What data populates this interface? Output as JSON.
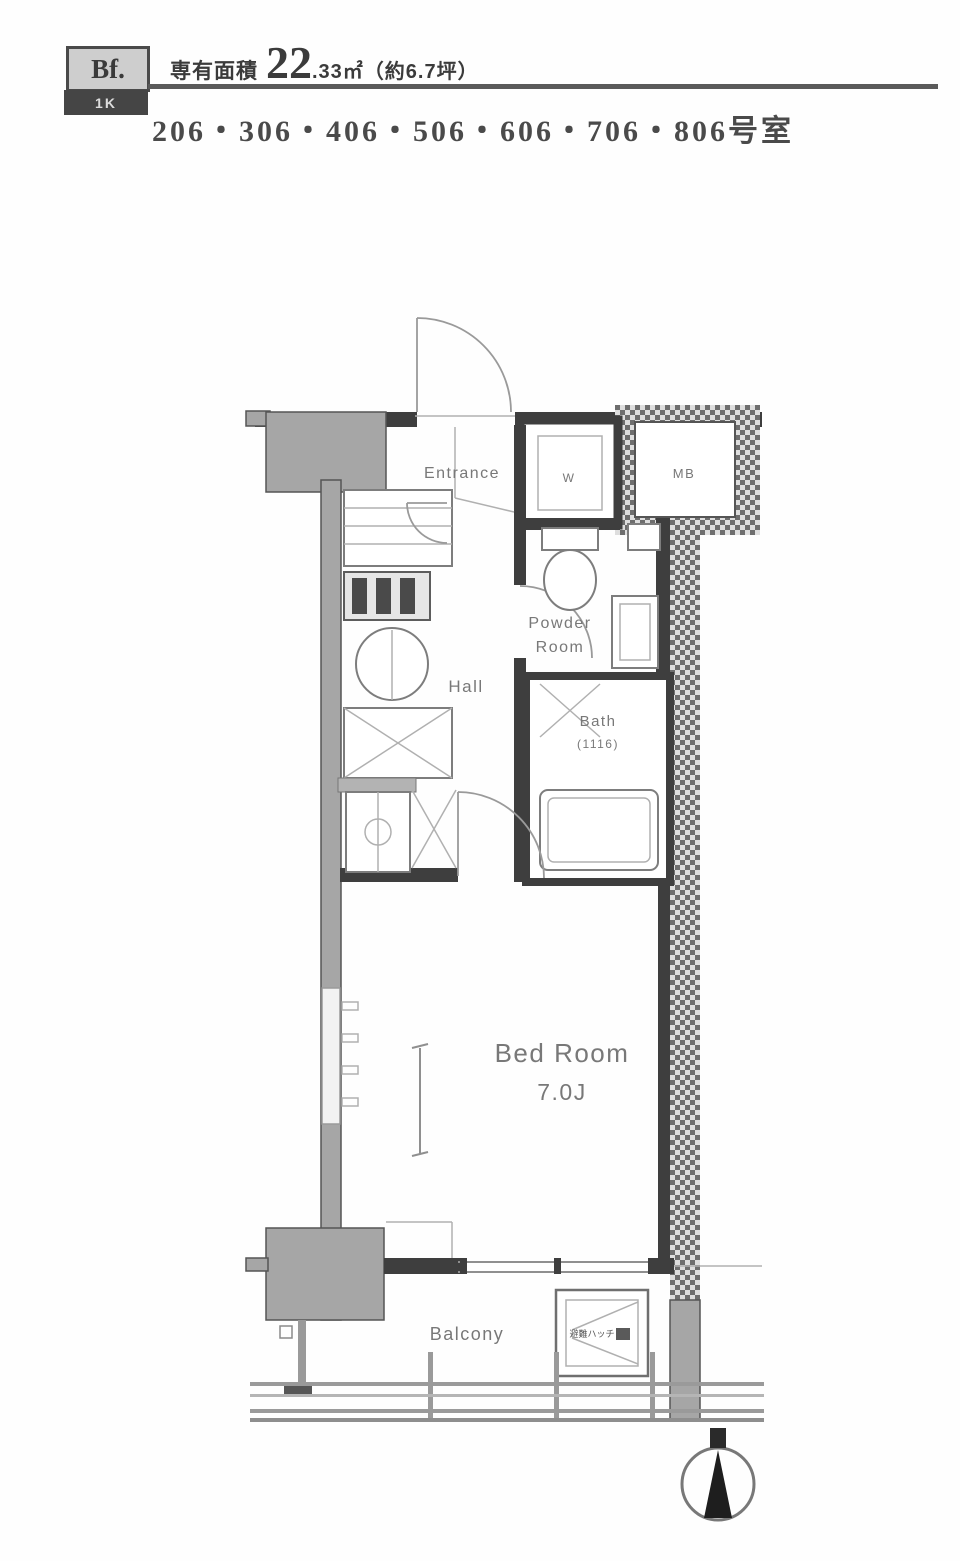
{
  "header": {
    "type_label": "Bf.",
    "unit_type": "1K",
    "area_label": "専有面積",
    "area_value": "22",
    "area_detail": ".33㎡（約6.7坪）",
    "room_numbers": "206・306・406・506・606・706・806号室"
  },
  "plan": {
    "labels": {
      "entrance": "Entrance",
      "hall": "Hall",
      "washer": "W",
      "meter_box": "MB",
      "powder_room_line1": "Powder",
      "powder_room_line2": "Room",
      "bath": "Bath",
      "bath_size": "(1116)",
      "bedroom_line1": "Bed Room",
      "bedroom_line2": "7.0J",
      "balcony": "Balcony",
      "evac_hatch": "避難ハッチ"
    },
    "colors": {
      "wall_dark": "#3e3e3e",
      "wall_gray": "#a6a6a6",
      "fixture_line": "#7d7d7d",
      "label_gray": "#787878"
    }
  }
}
